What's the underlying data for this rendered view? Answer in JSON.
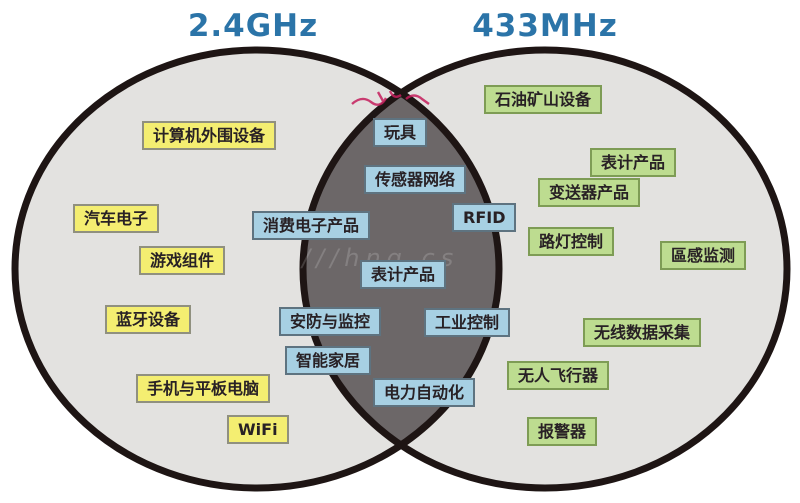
{
  "venn": {
    "left": {
      "title": "2.4GHz",
      "items": [
        "计算机外围设备",
        "汽车电子",
        "游戏组件",
        "蓝牙设备",
        "手机与平板电脑",
        "WiFi"
      ]
    },
    "overlap": {
      "items": [
        "玩具",
        "传感器网络",
        "RFID",
        "消费电子产品",
        "表计产品",
        "安防与监控",
        "工业控制",
        "智能家居",
        "电力自动化"
      ]
    },
    "right": {
      "title": "433MHz",
      "items": [
        "石油矿山设备",
        "表计产品",
        "变送器产品",
        "路灯控制",
        "區感监测",
        "无线数据采集",
        "无人飞行器",
        "报警器"
      ]
    },
    "watermark": "///hng.cs",
    "colors": {
      "left_label_bg": "#f4ee71",
      "overlap_label_bg": "#a7d0e3",
      "right_label_bg": "#bddc90",
      "circle_fill": "#e3e2e0",
      "overlap_fill": "#6c6768",
      "outline": "#1e1514",
      "title_color": "#2b74a8",
      "scribble_red": "#c51f5d"
    }
  }
}
